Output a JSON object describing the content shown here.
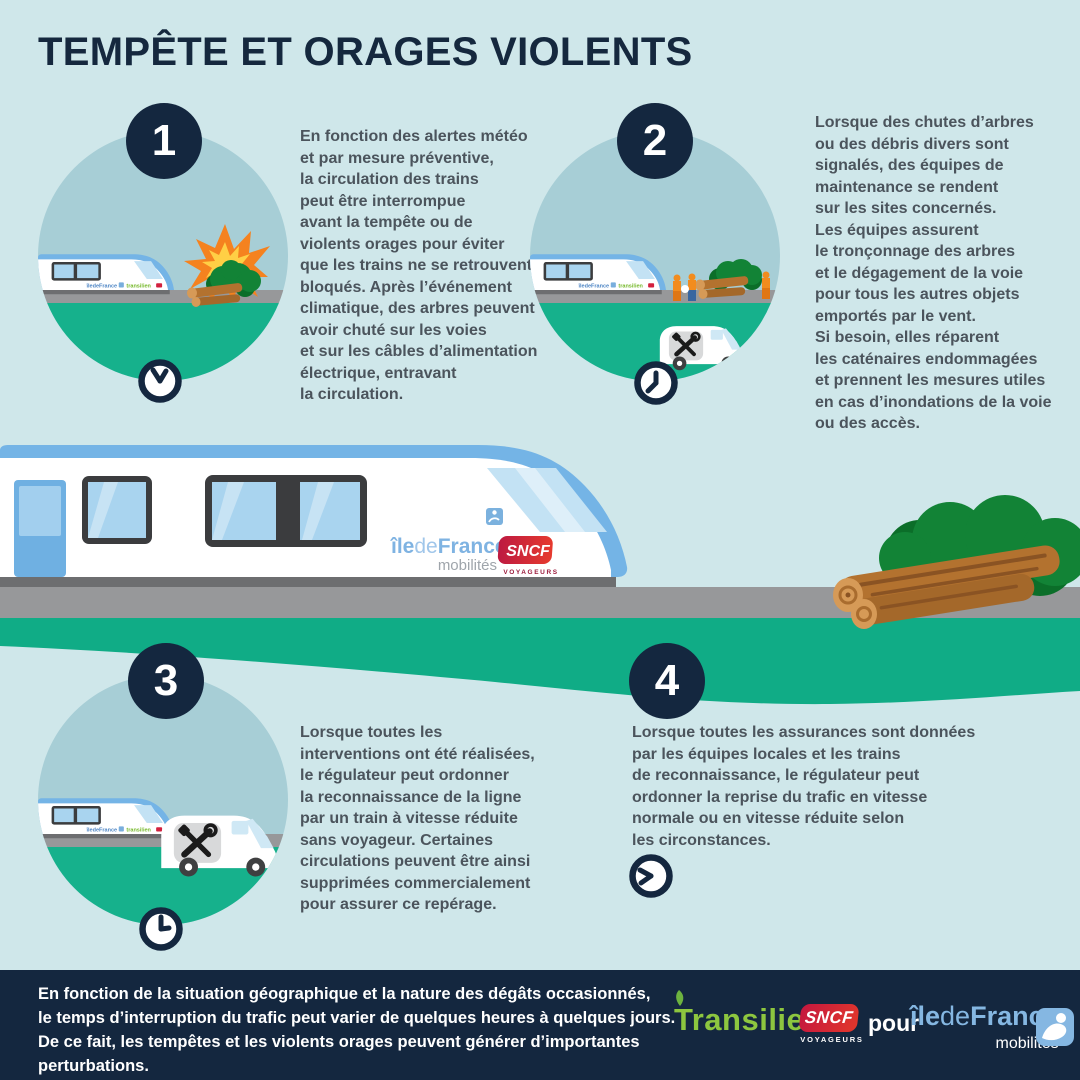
{
  "title": "TEMPÊTE ET ORAGES VIOLENTS",
  "steps": [
    {
      "number": "1",
      "text": "En fonction des alertes météo\net par mesure préventive,\nla circulation des trains\npeut être interrompue\navant la tempête ou de\nviolents orages pour éviter\nque les trains ne se retrouvent\nbloqués. Après l’événement\nclimatique, des arbres peuvent\navoir chuté sur les voies\net sur les câbles d’alimentation\nélectrique, entravant\nla circulation."
    },
    {
      "number": "2",
      "text": "Lorsque des chutes d’arbres\nou des débris divers sont\nsignalés, des équipes de\nmaintenance se rendent\nsur les sites concernés.\nLes équipes assurent\nle tronçonnage des arbres\net le dégagement de la voie\npour tous les autres objets\nemportés par le vent.\nSi besoin, elles réparent\nles caténaires endommagées\net prennent les mesures utiles\nen cas d’inondations de la voie\nou des accès."
    },
    {
      "number": "3",
      "text": "Lorsque toutes les\ninterventions ont été réalisées,\nle régulateur peut ordonner\nla reconnaissance de la ligne\npar un train à vitesse réduite\nsans voyageur. Certaines\ncirculations peuvent être ainsi\nsupprimées commercialement\npour assurer ce repérage."
    },
    {
      "number": "4",
      "text": "Lorsque toutes les assurances sont données\npar les équipes locales et les trains\nde reconnaissance, le régulateur peut\nordonner la reprise du trafic en vitesse\nnormale ou en vitesse réduite selon\nles circonstances."
    }
  ],
  "train": {
    "idf_ile": "île",
    "idf_de": "de",
    "idf_france": "France",
    "idf_sub": "mobilités",
    "sncf": "SNCF",
    "sncf_sub": "VOYAGEURS"
  },
  "mini_train": {
    "idf": "îledeFrance",
    "transilien": "transilien"
  },
  "footer": {
    "text": "En fonction de la situation géographique et la nature des dégâts occasionnés,\nle temps d’interruption du trafic peut varier de quelques heures à quelques jours.\nDe ce fait, les tempêtes et les violents orages peuvent générer d’importantes\nperturbations.",
    "transilien": "Transilien",
    "sncf": "SNCF",
    "sncf_sub": "VOYAGEURS",
    "pour": "pour",
    "idf_ile": "île",
    "idf_de": "de",
    "idf_france": "France",
    "idf_sub": "mobilités"
  },
  "colors": {
    "background": "#cfe7ea",
    "navy": "#14273f",
    "green_band": "#10ac86",
    "circle_sky": "#a7ced6",
    "track_gray": "#97989a",
    "train_blue": "#74b4e6",
    "body_text": "#4b545c",
    "transilien_green": "#8dc63f",
    "sncf_red": "#d2213e",
    "idf_blue": "#85b7e2",
    "explosion_orange": "#f5821f",
    "explosion_yellow": "#ffcf45",
    "log_brown": "#b3722f",
    "bush_green": "#128336"
  }
}
